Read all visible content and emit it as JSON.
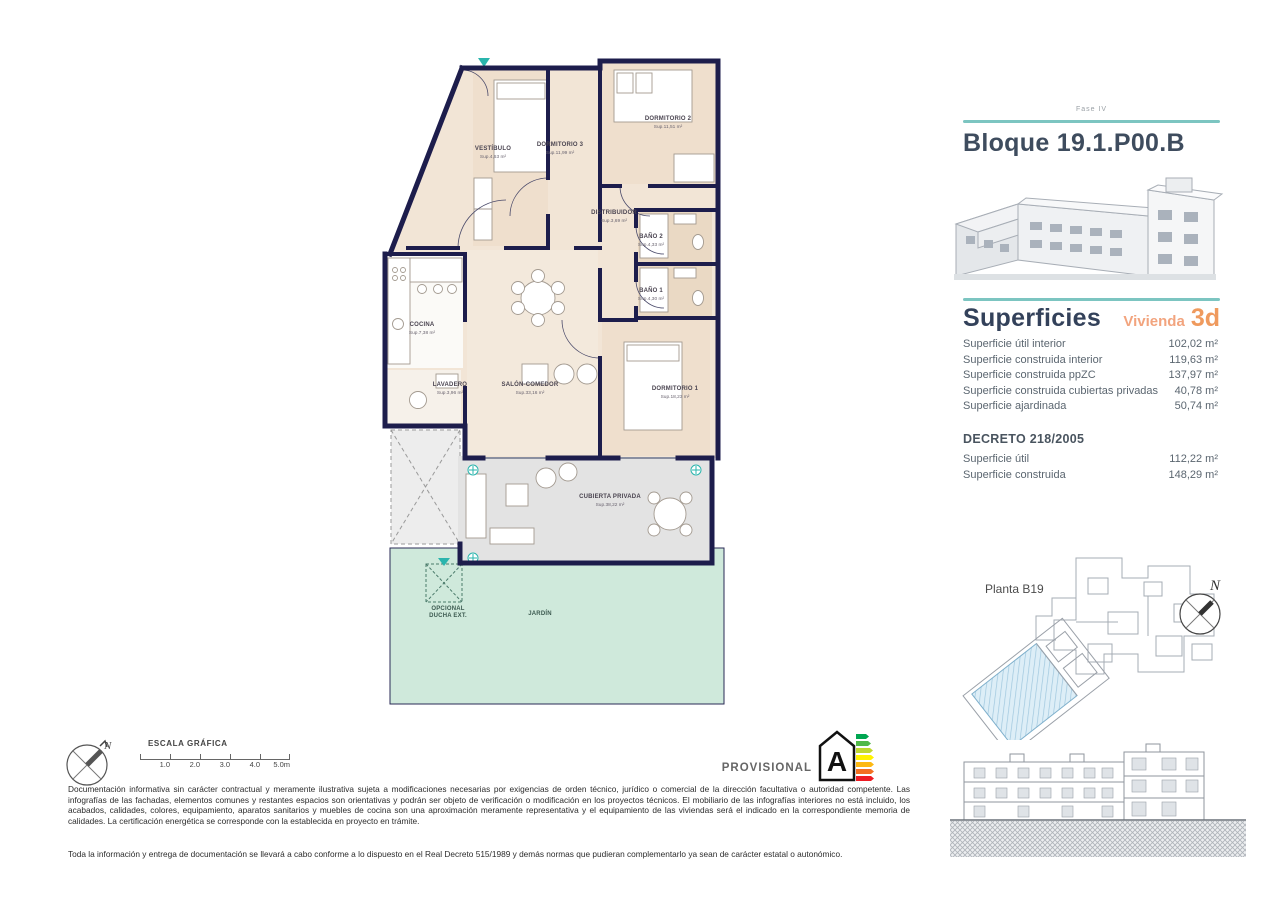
{
  "sidebar": {
    "fase": "Fase IV",
    "title": "Bloque 19.1.P00.B",
    "superficies": {
      "heading": "Superficies",
      "vivienda_label": "Vivienda",
      "vivienda_code": "3d",
      "rows": [
        {
          "label": "Superficie útil interior",
          "value": "102,02 m²"
        },
        {
          "label": "Superficie construida interior",
          "value": "119,63 m²"
        },
        {
          "label": "Superficie construida ppZC",
          "value": "137,97 m²"
        },
        {
          "label": "Superficie construida cubiertas privadas",
          "value": "40,78 m²"
        },
        {
          "label": "Superficie ajardinada",
          "value": "50,74 m²"
        }
      ]
    },
    "decreto": {
      "heading": "DECRETO 218/2005",
      "rows": [
        {
          "label": "Superficie útil",
          "value": "112,22 m²"
        },
        {
          "label": "Superficie construida",
          "value": "148,29 m²"
        }
      ]
    },
    "planta_label": "Planta B19"
  },
  "plan": {
    "vestibulo": {
      "name": "VESTÍBULO",
      "sup": "Sup.4,63 m²"
    },
    "dormitorio3": {
      "name": "DORMITORIO 3",
      "sup": "Sup.11,99 m²"
    },
    "dormitorio2": {
      "name": "DORMITORIO 2",
      "sup": "Sup.11,51 m²"
    },
    "distribuidor": {
      "name": "DISTRIBUIDOR",
      "sup": "Sup.3,69 m²"
    },
    "bano2": {
      "name": "BAÑO 2",
      "sup": "Sup.4,33 m²"
    },
    "bano1": {
      "name": "BAÑO 1",
      "sup": "Sup.4,30 m²"
    },
    "cocina": {
      "name": "COCINA",
      "sup": "Sup.7,38 m²"
    },
    "lavadero": {
      "name": "LAVADERO",
      "sup": "Sup.3,96 m²"
    },
    "salon": {
      "name": "SALÓN-COMEDOR",
      "sup": "Sup.33,16 m²"
    },
    "dormitorio1": {
      "name": "DORMITORIO 1",
      "sup": "Sup.18,23 m²"
    },
    "cubierta": {
      "name": "CUBIERTA PRIVADA",
      "sup": "Sup.38,22 m²"
    },
    "jardin": {
      "name": "JARDÍN"
    },
    "ducha": {
      "name1": "OPCIONAL",
      "name2": "DUCHA EXT."
    }
  },
  "footer": {
    "escala_label": "ESCALA GRÁFICA",
    "scale_ticks": [
      "1.0",
      "2.0",
      "3.0",
      "4.0",
      "5.0m"
    ],
    "disclaimer1": "Documentación informativa sin carácter contractual y meramente ilustrativa sujeta a modificaciones necesarias por exigencias de orden técnico, jurídico o comercial de la dirección facultativa o autoridad competente. Las infografías de las fachadas, elementos comunes y restantes espacios son orientativas y podrán ser objeto de verificación o modificación en los proyectos técnicos. El mobiliario de las infografías interiores no está incluido, los acabados, calidades, colores, equipamiento, aparatos sanitarios y muebles de cocina son una aproximación meramente representativa y el equipamiento de las viviendas será el indicado en la correspondiente memoria de calidades. La certificación energética se corresponde con la establecida en proyecto en trámite.",
    "disclaimer2": "Toda la información y entrega de documentación se llevará a cabo conforme a lo dispuesto en el Real Decreto 515/1989 y demás normas que pudieran complementarlo ya sean de carácter estatal o autonómico.",
    "provisional": "PROVISIONAL",
    "energy_rating": "A",
    "energy_colors": [
      "#00a651",
      "#50b848",
      "#bfd730",
      "#fff200",
      "#fdb913",
      "#f37021",
      "#ed1c24"
    ]
  },
  "colors": {
    "accent_teal": "#7cc5c1",
    "accent_orange": "#ef9a5e",
    "wall_navy": "#1d1d4c",
    "garden_green": "#cfe9db",
    "terrace_grey": "#e3e3e3",
    "room_beige": "#f2e5d6"
  }
}
